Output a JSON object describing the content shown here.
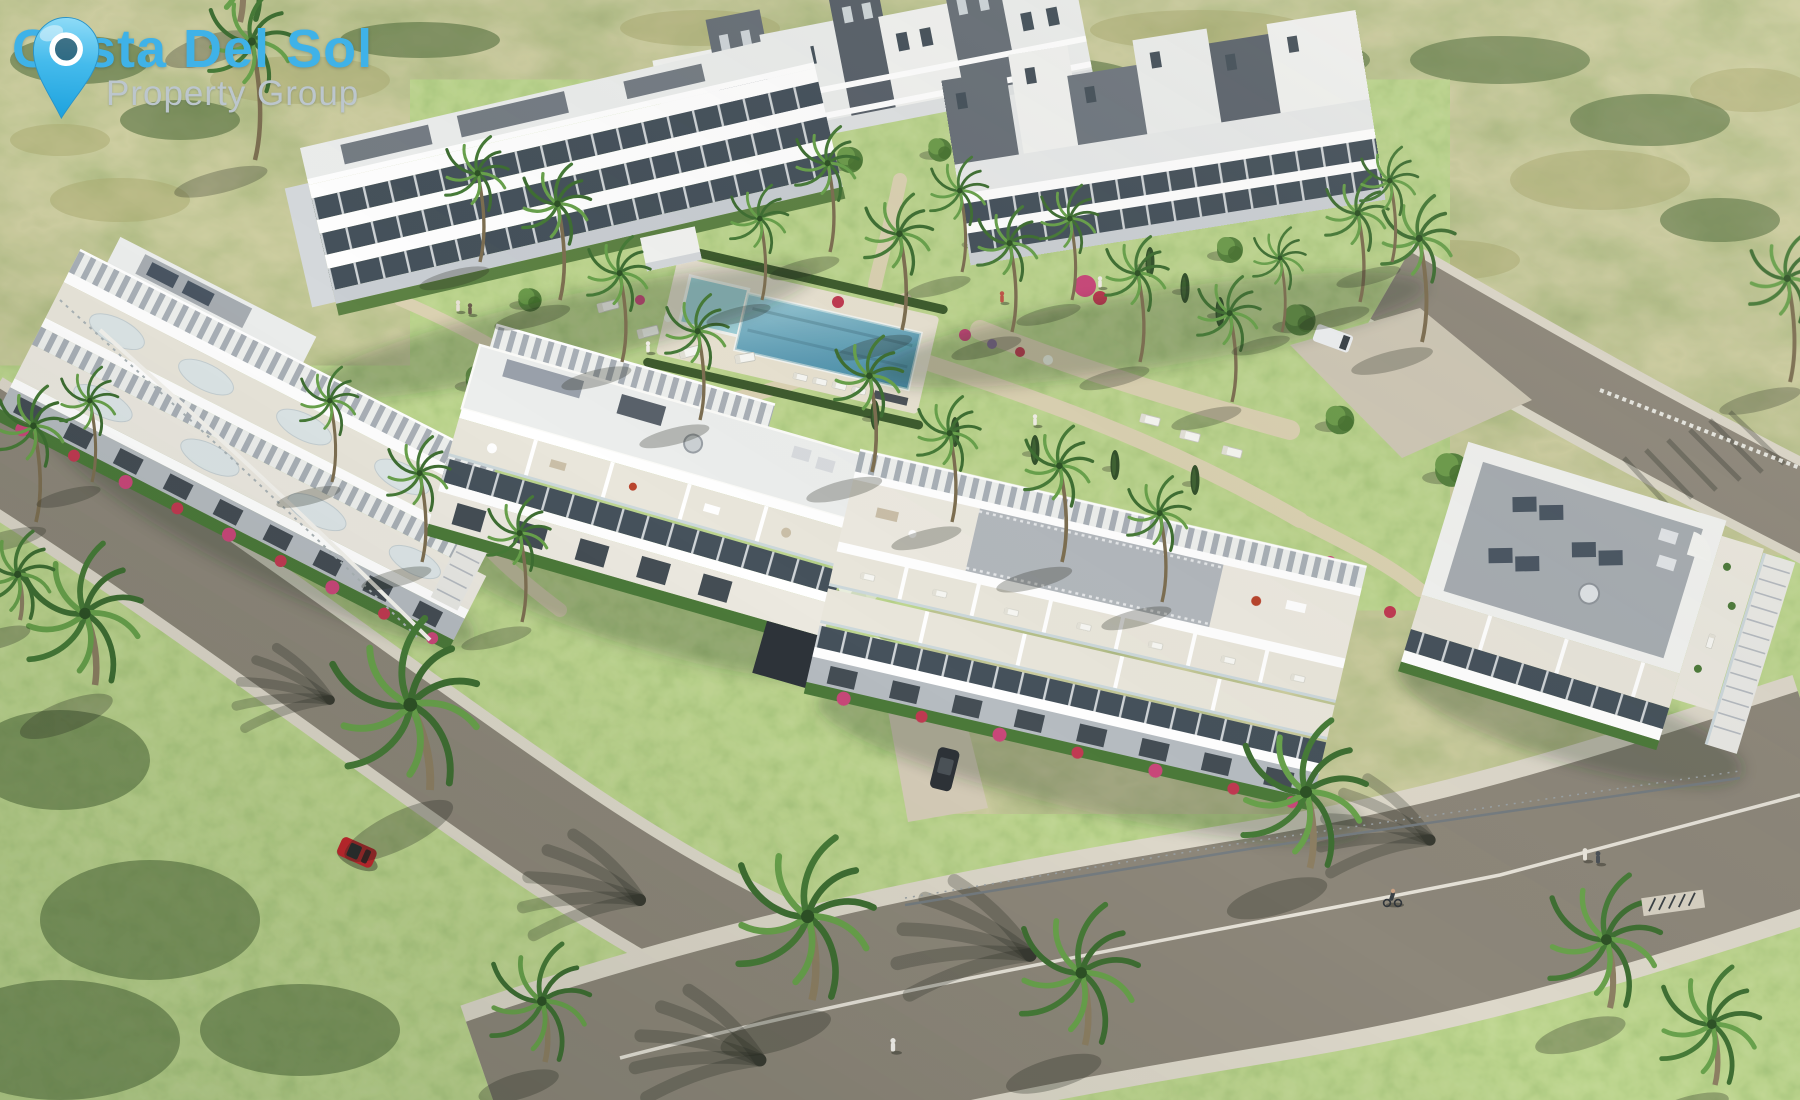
{
  "logo": {
    "title": "Costa Del Sol",
    "subtitle": "Property Group",
    "icon": "location-pin-icon"
  },
  "scene": {
    "description": "Aerial 3D render of a modern whitewashed apartment complex on a green hillside, with communal gardens, a swimming pool, palm trees and curved access roads.",
    "objects": [
      "apartment-blocks",
      "communal-swimming-pool",
      "landscaped-gardens",
      "palm-trees",
      "access-roads",
      "red-car",
      "dark-car",
      "white-van",
      "pedestrians",
      "cyclist",
      "bike-rack",
      "sun-loungers"
    ]
  },
  "colors": {
    "logo_blue": "#3fb2e8",
    "logo_gray": "#bcc6cd",
    "scrub_green": "#7d8d58",
    "lawn_green": "#7fae52",
    "hedge_green": "#44602f",
    "palm_green": "#55853f",
    "path_beige": "#dbd2b2",
    "road_asphalt": "#8d877a",
    "sidewalk": "#ddd8ca",
    "pool_blue": "#5b9cb6",
    "pool_light": "#9fd0d8",
    "building_white": "#f2f3f1",
    "building_shadow": "#d5d9dc",
    "building_dark_gray": "#697179",
    "window_dark": "#46525c",
    "roof_gray": "#a7adb2",
    "solar_panel": "#4a5663",
    "bougainvillea_pink": "#c9487a",
    "car_red": "#c1272d",
    "car_dark": "#2e3338",
    "van_white": "#eef0f2"
  }
}
